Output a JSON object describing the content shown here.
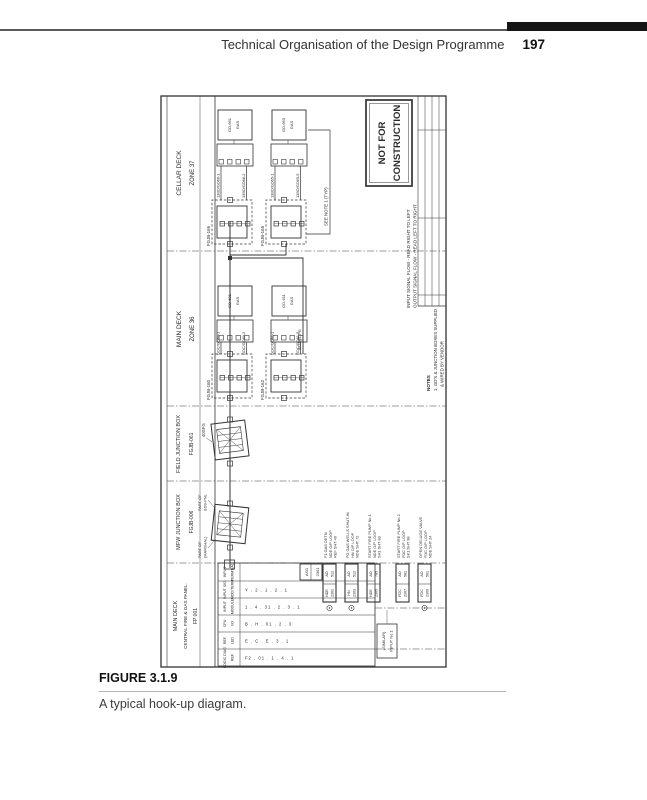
{
  "page_header": {
    "title": "Technical Organisation of the Design Programme",
    "page_number": "197"
  },
  "caption": {
    "label": "FIGURE 3.1.9",
    "text": "A typical hook-up diagram."
  },
  "colors": {
    "ink": "#2b2b2b",
    "bar": "#151515"
  },
  "drawing": {
    "sections": [
      {
        "name": "MAIN DECK",
        "sub": "CENTRAL FIRE & GAS PANEL.",
        "id": "FP 001"
      },
      {
        "name": "MFW JUNCTION BOX",
        "id": "FGJB-006"
      },
      {
        "name": "FIELD JUNCTION BOX",
        "id": "FGJB-061"
      },
      {
        "name": "MAIN DECK",
        "id": "ZONE 36"
      },
      {
        "name": "CELLAR DECK",
        "id": "ZONE 37"
      }
    ],
    "stamp": {
      "line1": "NOT FOR",
      "line2": "CONSTRUCTION"
    },
    "flow_notes": [
      "INPUT SIGNAL FLOW - READ RIGHT TO LEFT",
      "OUTPUT SIGNAL FLOW - READ LEFT TO RIGHT"
    ],
    "notes": {
      "title": "NOTES",
      "line1": "1. GD'S & JUNCTION BOXES SUPPLIED",
      "line2": "& WIRED BY VENDOR"
    },
    "see_note": "SEE NOTE 1 (TYP)",
    "branch_tag": "8/GD61-PG",
    "field_jb": {
      "cable": "40GFG"
    },
    "mfw_jb": {
      "label_left": [
        "PART OF",
        "(MARSHAL)"
      ],
      "label_right": [
        "PART OF",
        "BDS-PNL"
      ]
    },
    "cellar": {
      "jb_labels": [
        "FGJB-166",
        "FGJB-165"
      ],
      "cables": [
        "13BD/GD66-1",
        "13BD/GD66-2",
        "13BD/GD65-1",
        "13BD/GD65-5"
      ],
      "detectors": [
        [
          "GD-661",
          "GAS"
        ],
        [
          "GD-663",
          "GAS"
        ]
      ]
    },
    "main": {
      "jb_labels": [
        "FGJB-160",
        "FGJB-162"
      ],
      "cables": [
        "GDC/GD60-1",
        "GDC/GD60-2",
        "GDC/GD61-1",
        "GDC/GD61-5"
      ],
      "detectors": [
        [
          "GD-601",
          "GAS"
        ],
        [
          "GD-611",
          "GAS"
        ]
      ]
    },
    "panel": {
      "col_headers": [
        [
          "LOGIC DIAG",
          "REF"
        ],
        [
          "REF",
          "LED"
        ],
        [
          "CPU",
          "I/O"
        ],
        [
          "INPUT",
          "MODULE"
        ],
        [
          "INPUT SIG.",
          "MOD/TERM"
        ],
        [
          "INPUT",
          "TERM'NAL"
        ]
      ],
      "col_values": [
        "F2 . 01 . 1 . 4 . 1",
        "E . C . E . 3 . 1",
        "B . H . 01 . 2 . 3",
        "1 . 4 . 31 . 2 . 3 . 1",
        "Y . 2 . 1 . 2 . 1"
      ],
      "terminal_box": [
        "AI01",
        "2301"
      ],
      "similar_box": [
        "(SIMILAR)",
        "INPUT No.1"
      ]
    },
    "io_points": [
      {
        "cells": [
          "NDE",
          "2301",
          "AO",
          "512"
        ],
        "desc": [
          "F1 GAS DETN",
          "NDE O/P LOOP",
          "REF SHT 40"
        ]
      },
      {
        "cells": [
          "HN",
          "2303",
          "AO",
          "512"
        ],
        "desc": [
          "FG GAS WELLS SHUT-IN",
          "HN O/P LOOP",
          "NDE SHT 72"
        ]
      },
      {
        "cells": [
          "NDE",
          "2305",
          "AO",
          "785"
        ],
        "desc": [
          "START FIRE PUMP No 1",
          "NDE O/P LOOP",
          "SH1 SHT 83"
        ]
      },
      {
        "cells": [
          "FDC",
          "2307",
          "AO",
          "581"
        ],
        "desc": [
          "START FIRE PUMP No 2",
          "FDC O/P LOOP",
          "SK1 SHT 98"
        ]
      },
      {
        "cells": [
          "FDC",
          "2309",
          "AO",
          "561"
        ],
        "desc": [
          "OPEN DELUGE VALVE",
          "FDC O/P LOOP",
          "NDE SHT 24"
        ]
      }
    ]
  }
}
